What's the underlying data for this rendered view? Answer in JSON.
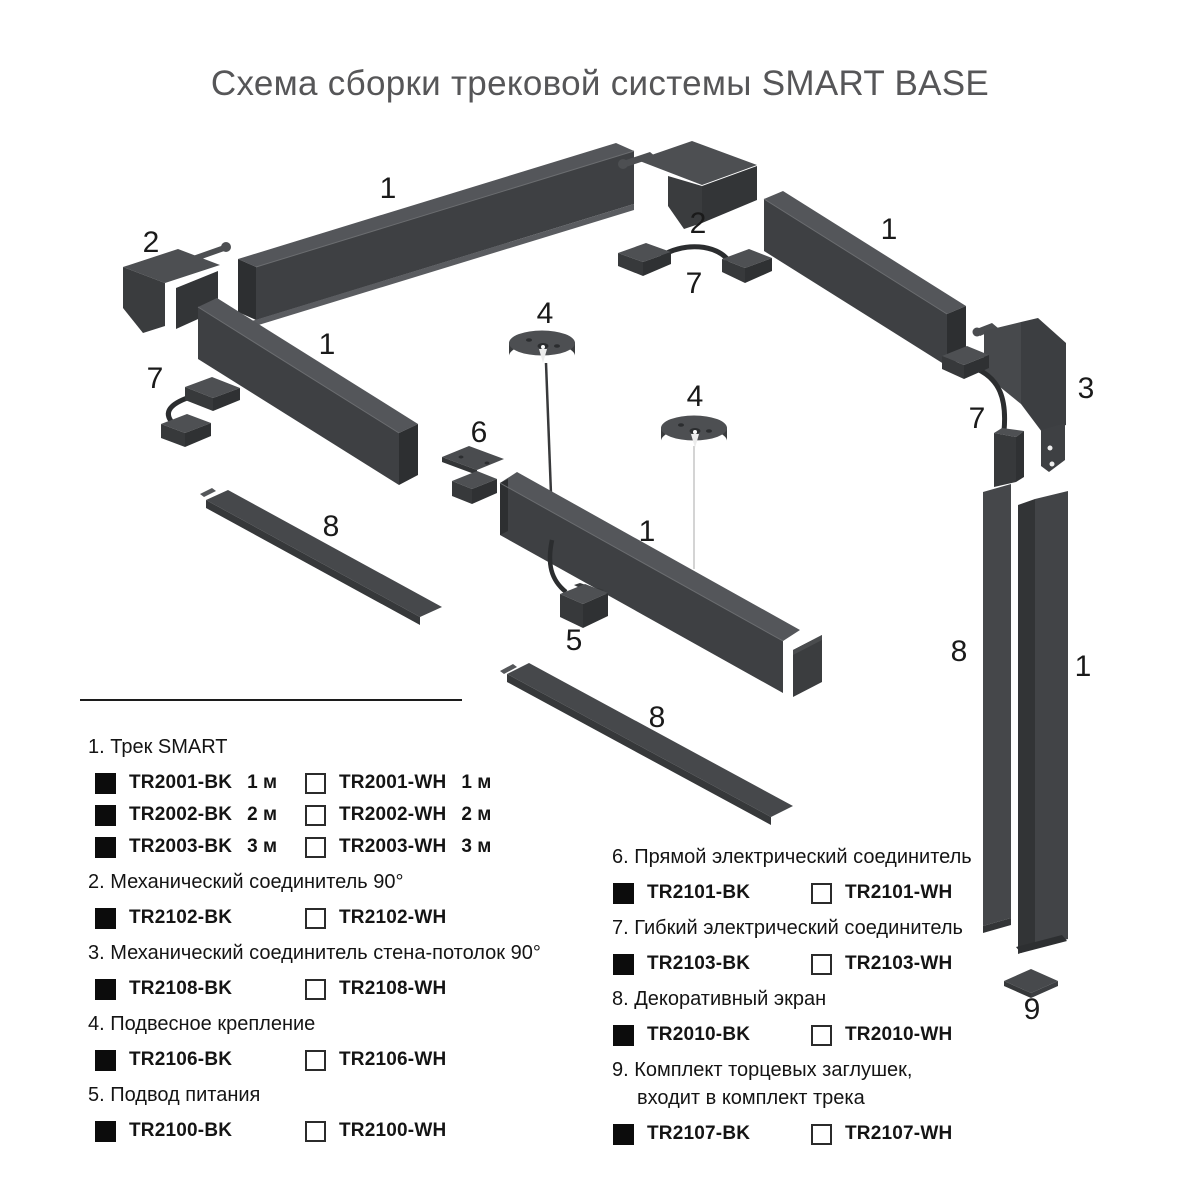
{
  "title": "Схема сборки трековой системы SMART BASE",
  "colors": {
    "track_top": "#54565a",
    "track_front": "#3e4043",
    "track_dark": "#2d2f31",
    "screen_face": "#46484b",
    "label": "#1a1a1a",
    "swatch_black": "#0c0c0c"
  },
  "diagram_labels": {
    "track_top_left": "1",
    "corner_left": "2",
    "track_left_wall": "1",
    "flex_left": "7",
    "screen_left": "8",
    "corner_top": "2",
    "flex_top": "7",
    "track_top_right": "1",
    "wall_ceiling": "3",
    "flex_right": "7",
    "pendant_left": "4",
    "pendant_right": "4",
    "straight_connector": "6",
    "track_center": "1",
    "power_feed": "5",
    "screen_center": "8",
    "screen_vertical": "8",
    "track_vertical": "1",
    "end_cap": "9"
  },
  "legend": {
    "sections": [
      {
        "label": "1. Трек SMART",
        "items": [
          {
            "variant": "black",
            "code": "TR2001-BK",
            "size": "1 м"
          },
          {
            "variant": "white",
            "code": "TR2001-WH",
            "size": "1 м"
          },
          {
            "variant": "black",
            "code": "TR2002-BK",
            "size": "2 м"
          },
          {
            "variant": "white",
            "code": "TR2002-WH",
            "size": "2 м"
          },
          {
            "variant": "black",
            "code": "TR2003-BK",
            "size": "3 м"
          },
          {
            "variant": "white",
            "code": "TR2003-WH",
            "size": "3 м"
          }
        ]
      },
      {
        "label": "2. Механический соединитель 90°",
        "items": [
          {
            "variant": "black",
            "code": "TR2102-BK"
          },
          {
            "variant": "white",
            "code": "TR2102-WH"
          }
        ]
      },
      {
        "label": "3. Механический соединитель стена-потолок 90°",
        "items": [
          {
            "variant": "black",
            "code": "TR2108-BK"
          },
          {
            "variant": "white",
            "code": "TR2108-WH"
          }
        ]
      },
      {
        "label": "4. Подвесное крепление",
        "items": [
          {
            "variant": "black",
            "code": "TR2106-BK"
          },
          {
            "variant": "white",
            "code": "TR2106-WH"
          }
        ]
      },
      {
        "label": "5. Подвод питания",
        "items": [
          {
            "variant": "black",
            "code": "TR2100-BK"
          },
          {
            "variant": "white",
            "code": "TR2100-WH"
          }
        ]
      },
      {
        "label": "6. Прямой электрический соединитель",
        "items": [
          {
            "variant": "black",
            "code": "TR2101-BK"
          },
          {
            "variant": "white",
            "code": "TR2101-WH"
          }
        ]
      },
      {
        "label": "7. Гибкий электрический соединитель",
        "items": [
          {
            "variant": "black",
            "code": "TR2103-BK"
          },
          {
            "variant": "white",
            "code": "TR2103-WH"
          }
        ]
      },
      {
        "label": "8. Декоративный экран",
        "items": [
          {
            "variant": "black",
            "code": "TR2010-BK"
          },
          {
            "variant": "white",
            "code": "TR2010-WH"
          }
        ]
      },
      {
        "label": "9. Комплект торцевых заглушек,",
        "label2": "входит в комплект трека",
        "items": [
          {
            "variant": "black",
            "code": "TR2107-BK"
          },
          {
            "variant": "white",
            "code": "TR2107-WH"
          }
        ]
      }
    ]
  }
}
